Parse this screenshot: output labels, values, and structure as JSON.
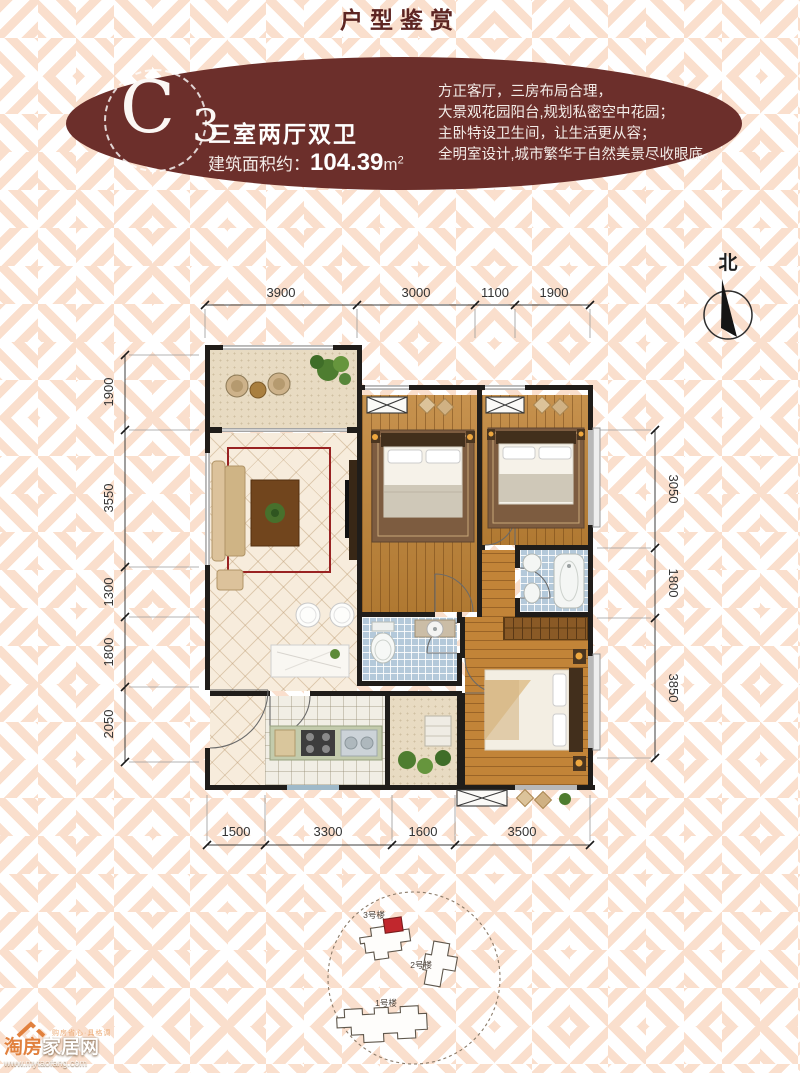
{
  "page": {
    "title": "户型鉴赏"
  },
  "badge": {
    "unit_letter": "C",
    "unit_number": "3",
    "layout_label": "三室两厅双卫",
    "area_label": "建筑面积约：",
    "area_value": "104.39",
    "area_unit": "m",
    "area_exponent": "2"
  },
  "description": {
    "line1": "方正客厅，三房布局合理，",
    "line2": "大景观花园阳台,规划私密空中花园；",
    "line3": "主卧特设卫生间，让生活更从容；",
    "line4": "全明室设计,城市繁华于自然美景尽收眼底。"
  },
  "compass": {
    "label": "北"
  },
  "floorplan": {
    "dims": {
      "top": [
        "3900",
        "3000",
        "1100",
        "1900"
      ],
      "left": [
        "1900",
        "3550",
        "1300",
        "1800",
        "2050"
      ],
      "right": [
        "3050",
        "1800",
        "3850"
      ],
      "bottom": [
        "1500",
        "3300",
        "1600",
        "3500"
      ]
    }
  },
  "siteplan": {
    "buildings": [
      {
        "label": "3号楼"
      },
      {
        "label": "2号楼"
      },
      {
        "label": "1号楼"
      }
    ],
    "highlight_color": "#c1272d"
  },
  "watermark": {
    "brand_primary": "淘房",
    "brand_secondary": "家居网",
    "url": "www.mytaofang.com",
    "tagline": "购房省心·具格调"
  },
  "colors": {
    "maroon": "#6c2f2b",
    "pattern": "#fadfcd",
    "wood": "#bf8336",
    "bath_tile": "#b4c9da"
  }
}
